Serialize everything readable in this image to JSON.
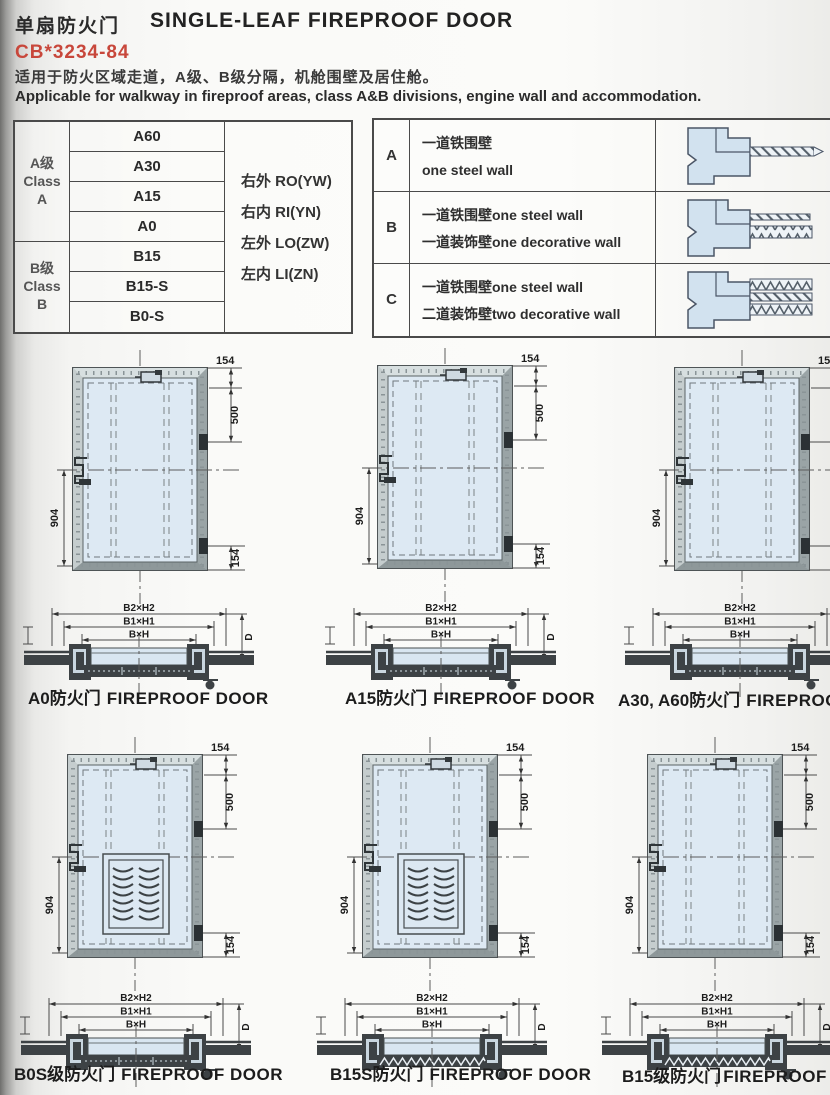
{
  "header": {
    "title_cn": "单扇防火门",
    "title_en": "SINGLE-LEAF FIREPROOF DOOR",
    "standard": "CB*3234-84",
    "desc_cn": "适用于防火区域走道，A级、B级分隔，机舱围壁及居住舱。",
    "desc_en": "Applicable for walkway in fireproof areas, class A&B divisions, engine wall and accommodation."
  },
  "class_table": {
    "group_a": {
      "line1": "A级",
      "line2": "Class",
      "line3": "A"
    },
    "group_b": {
      "line1": "B级",
      "line2": "Class",
      "line3": "B"
    },
    "models_a": [
      "A60",
      "A30",
      "A15",
      "A0"
    ],
    "models_b": [
      "B15",
      "B15-S",
      "B0-S"
    ],
    "orientations": [
      "右外 RO(YW)",
      "右内 RI(YN)",
      "左外 LO(ZW)",
      "左内 LI(ZN)"
    ]
  },
  "wall_table": {
    "rows": [
      {
        "key": "A",
        "line1": "一道铁围壁",
        "line2": "one steel wall"
      },
      {
        "key": "B",
        "line1": "一道铁围壁one steel wall",
        "line2": "一道装饰壁one decorative wall"
      },
      {
        "key": "C",
        "line1": "一道铁围壁one steel wall",
        "line2": "二道装饰壁two decorative wall"
      }
    ]
  },
  "drawing": {
    "dim_top": "154",
    "dim_upper": "500",
    "dim_bottom": "154",
    "dim_left": "904",
    "sec_outer": "B2×H2",
    "sec_mid": "B1×H1",
    "sec_inner": "B×H",
    "sec_depth": "D"
  },
  "figures": [
    {
      "caption_cn": "A0防火门",
      "caption_en": "FIREPROOF DOOR"
    },
    {
      "caption_cn": "A15防火门",
      "caption_en": "FIREPROOF DOOR"
    },
    {
      "caption_cn": "A30, A60防火门",
      "caption_en": "FIREPROOF DOOR"
    },
    {
      "caption_cn": "B0S级防火门",
      "caption_en": "FIREPROOF DOOR"
    },
    {
      "caption_cn": "B15S防火门",
      "caption_en": "FIREPROOF DOOR"
    },
    {
      "caption_cn": "B15级防火门",
      "caption_en": "FIREPROOF DOOR"
    }
  ],
  "colors": {
    "accent_red": "#c8473b",
    "panel_blue": "#dde9f3",
    "frame_grey": "#b3bdbf",
    "line_dark": "#3f3f3f"
  }
}
